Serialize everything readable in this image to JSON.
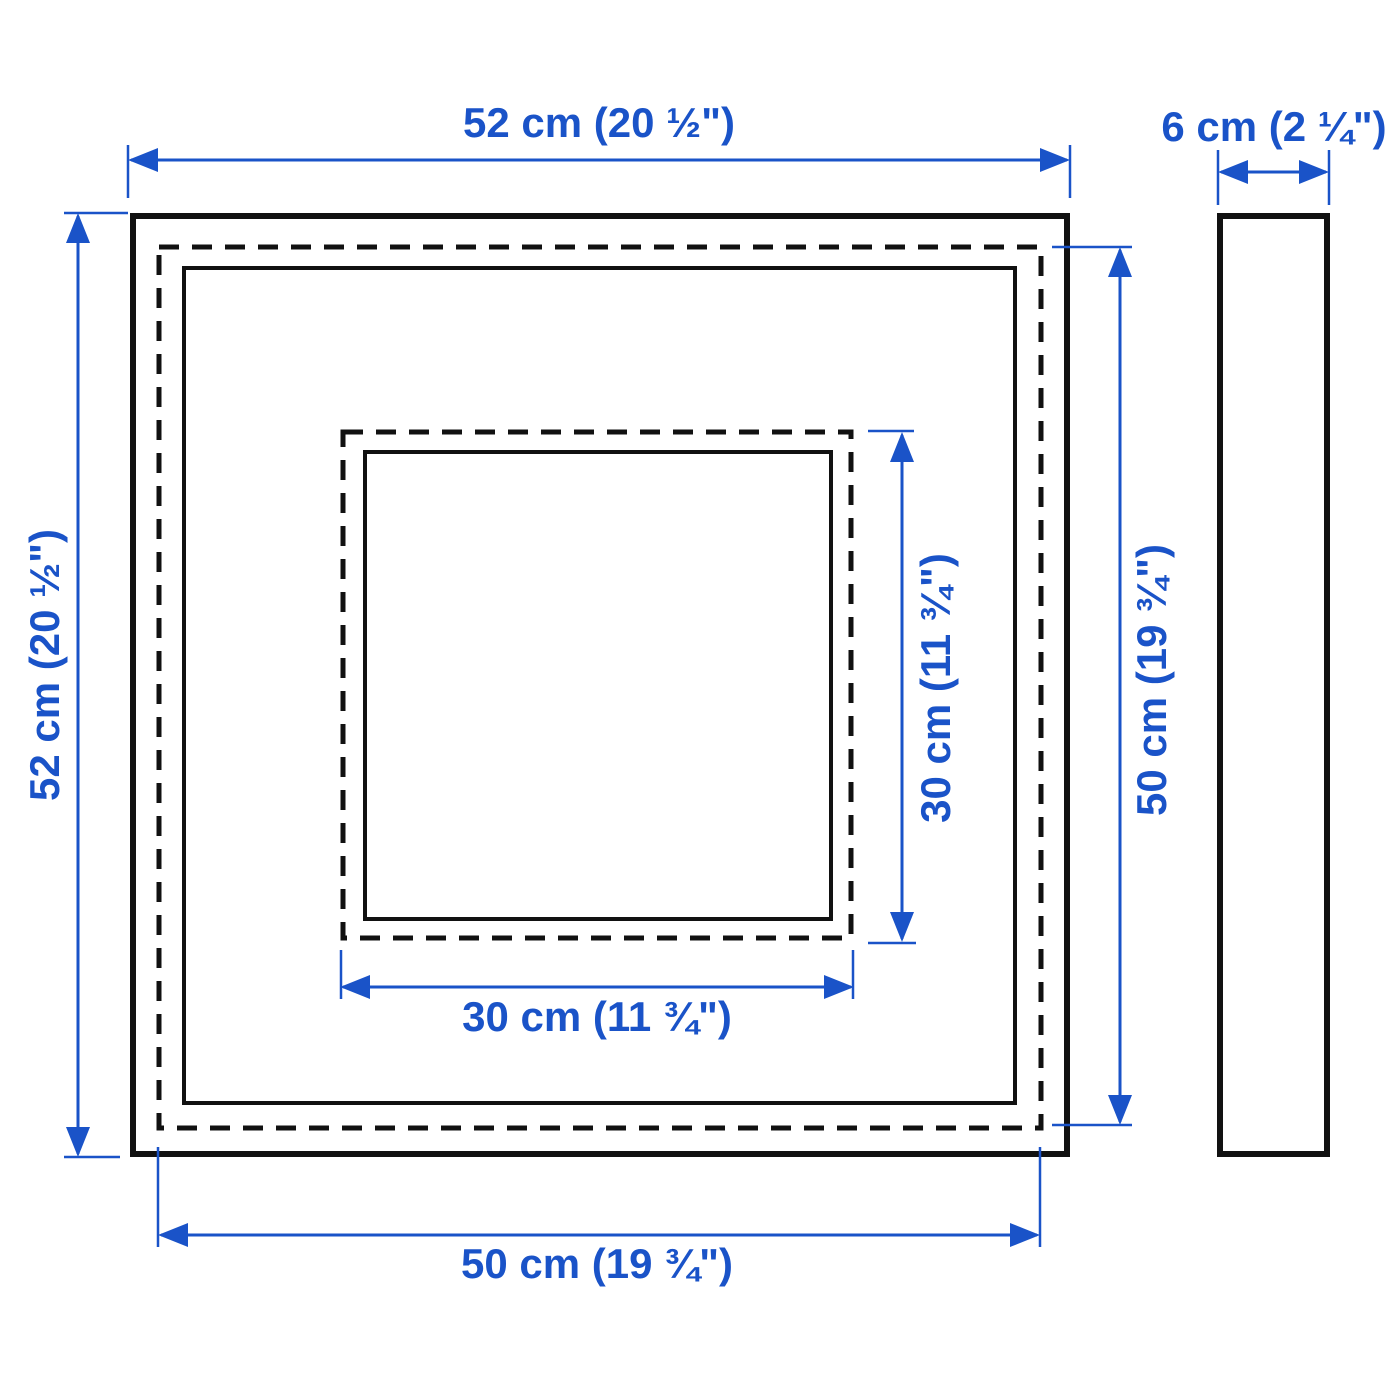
{
  "meta": {
    "accent_color": "#1a53c8",
    "outline_color": "#111111",
    "background_color": "#ffffff",
    "drawing_type": "product dimension diagram (frame front view and side view)"
  },
  "diagram": {
    "front_view": {
      "labels": {
        "outer_width": "52 cm (20 ½\")",
        "outer_height": "52 cm (20 ½\")",
        "back_width": "50 cm (19 ¾\")",
        "back_height": "50 cm (19 ¾\")",
        "opening_width": "30 cm (11 ¾\")",
        "opening_height": "30 cm (11 ¾\")"
      }
    },
    "side_view": {
      "labels": {
        "depth": "6 cm (2 ¼\")"
      }
    }
  }
}
